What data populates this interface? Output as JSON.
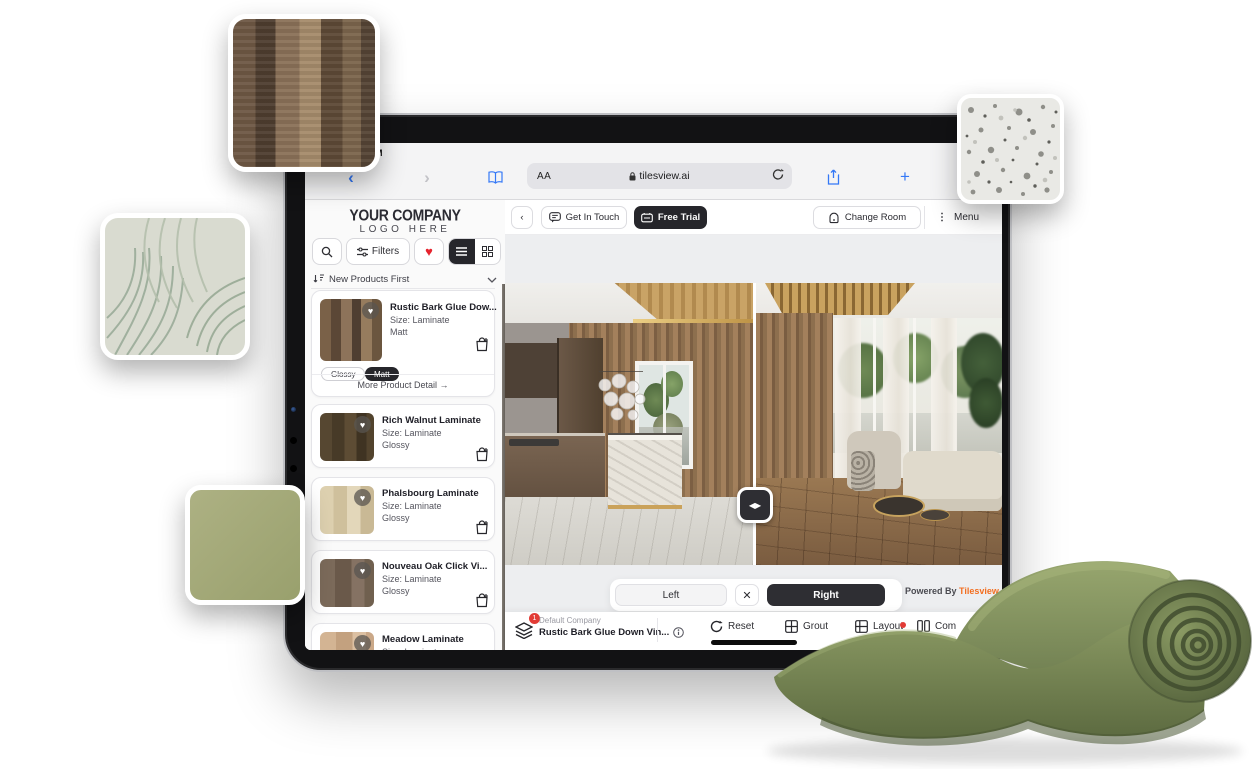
{
  "colors": {
    "accent_blue": "#3478f6",
    "brand_orange": "#f36f21",
    "heart_red": "#e6242e",
    "dark_button": "#26262b",
    "carpet_green": "#74834f",
    "badge_red": "#e23b35"
  },
  "device": {
    "status_time": "PM"
  },
  "browser": {
    "reader_label": "AA",
    "url": "tilesview.ai"
  },
  "header": {
    "get_in_touch": "Get In Touch",
    "free_trial": "Free Trial",
    "change_room": "Change Room",
    "menu": "Menu"
  },
  "sidebar": {
    "logo_line1": "YOUR COMPANY",
    "logo_line2": "LOGO HERE",
    "filters_label": "Filters",
    "sort_label": "New Products First",
    "products": [
      {
        "name": "Rustic Bark Glue Dow...",
        "size": "Size: Laminate",
        "finish": "Matt",
        "chips": [
          "Glossy",
          "Matt"
        ],
        "more_label": "More Product Detail",
        "more_arrow": "→"
      },
      {
        "name": "Rich Walnut Laminate",
        "size": "Size: Laminate",
        "finish": "Glossy"
      },
      {
        "name": "Phalsbourg Laminate",
        "size": "Size: Laminate",
        "finish": "Glossy"
      },
      {
        "name": "Nouveau Oak Click Vi...",
        "size": "Size: Laminate",
        "finish": "Glossy"
      },
      {
        "name": "Meadow Laminate",
        "size": "Size: Laminate",
        "finish": ""
      }
    ]
  },
  "viewer": {
    "floor_tag": "Floor",
    "check_glyph": "✓",
    "handle_glyphs": "◀▶",
    "left_label": "Left",
    "close_glyph": "✕",
    "right_label": "Right",
    "powered_by": "Powered By",
    "brand": "Tilesview"
  },
  "bottom_bar": {
    "badge_count": "1",
    "company": "Default Company",
    "product": "Rustic Bark Glue Down Vin...",
    "reset": "Reset",
    "grout": "Grout",
    "layout": "Layout",
    "compare": "Com"
  }
}
